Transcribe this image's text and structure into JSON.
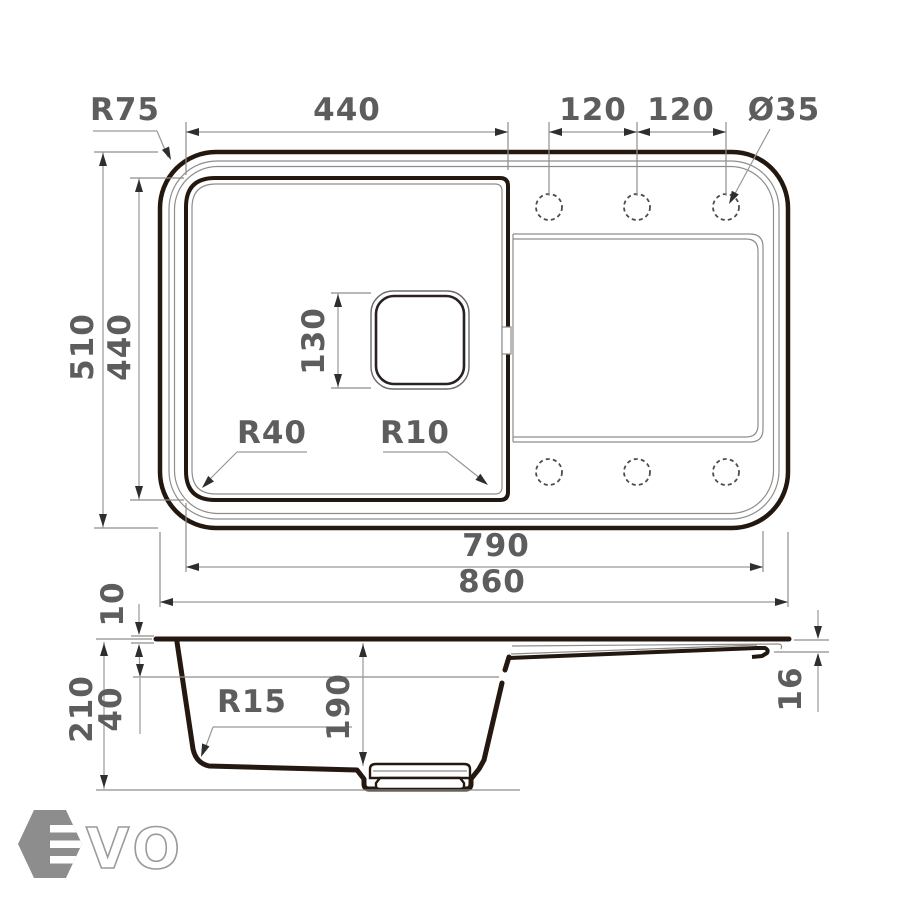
{
  "drawing": {
    "dimensions_top_view": {
      "corner_radius": "R75",
      "bowl_width": "440",
      "hole_spacing_left": "120",
      "hole_spacing_right": "120",
      "hole_diameter": "Ø35",
      "overall_depth": "510",
      "bowl_depth": "440",
      "drain_size": "130",
      "bowl_corner_radius_left": "R40",
      "bowl_corner_radius_right": "R10",
      "inner_length": "790",
      "overall_length": "860"
    },
    "dimensions_side_view": {
      "rim_thickness": "10",
      "overall_height": "210",
      "ledge_depth": "40",
      "bowl_inner_depth": "190",
      "bottom_corner_radius": "R15",
      "edge_thickness": "16"
    },
    "logo": {
      "brand": "EVO",
      "wordmark_visible": "VO"
    },
    "colors": {
      "background": "#ffffff",
      "line_dark": "#221810",
      "line_thin": "#8f8d8a",
      "dimension_text": "#5d5d5d",
      "logo_gray": "#8d8d8d"
    }
  }
}
